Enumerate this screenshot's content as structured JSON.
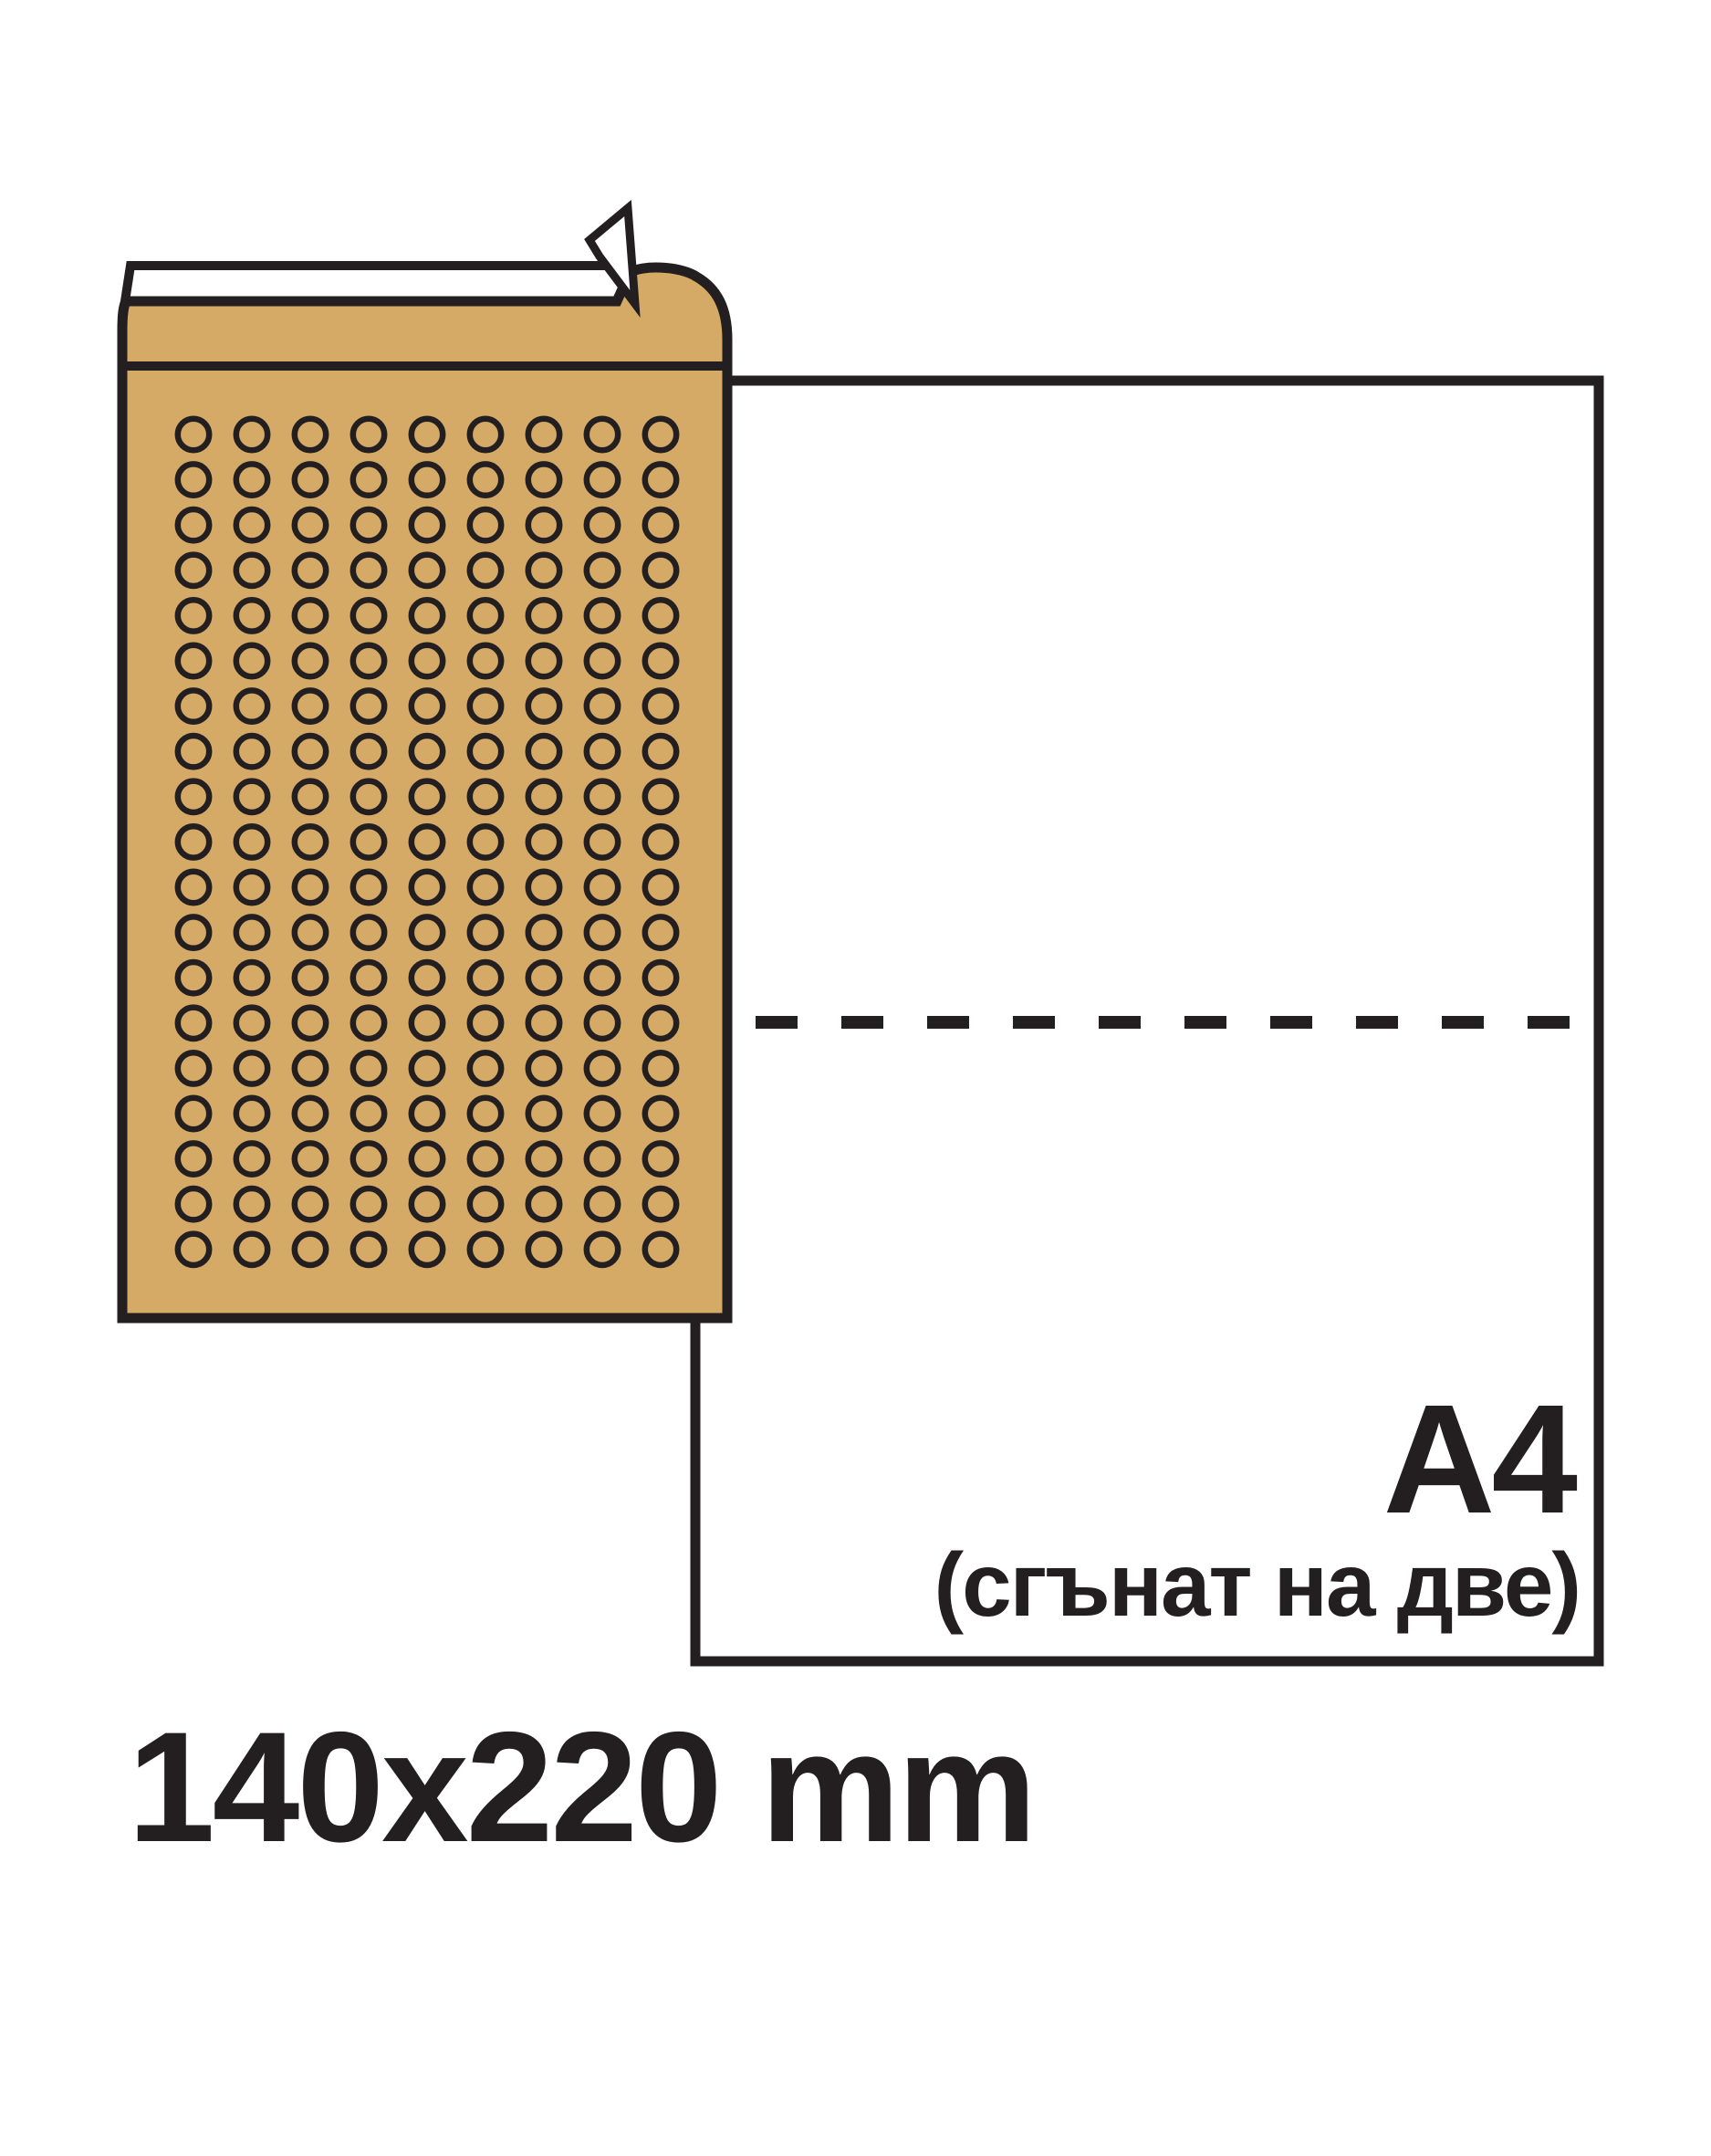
{
  "envelope": {
    "size_label": "140x220 mm",
    "fill_color": "#D5A966",
    "bubble_columns": 9,
    "bubble_rows": 19
  },
  "sheet": {
    "label": "A4",
    "sublabel": "(сгънат на две)"
  },
  "colors": {
    "outline": "#231F20",
    "envelope_tan": "#D5A966",
    "paper_white": "#FFFFFF"
  }
}
